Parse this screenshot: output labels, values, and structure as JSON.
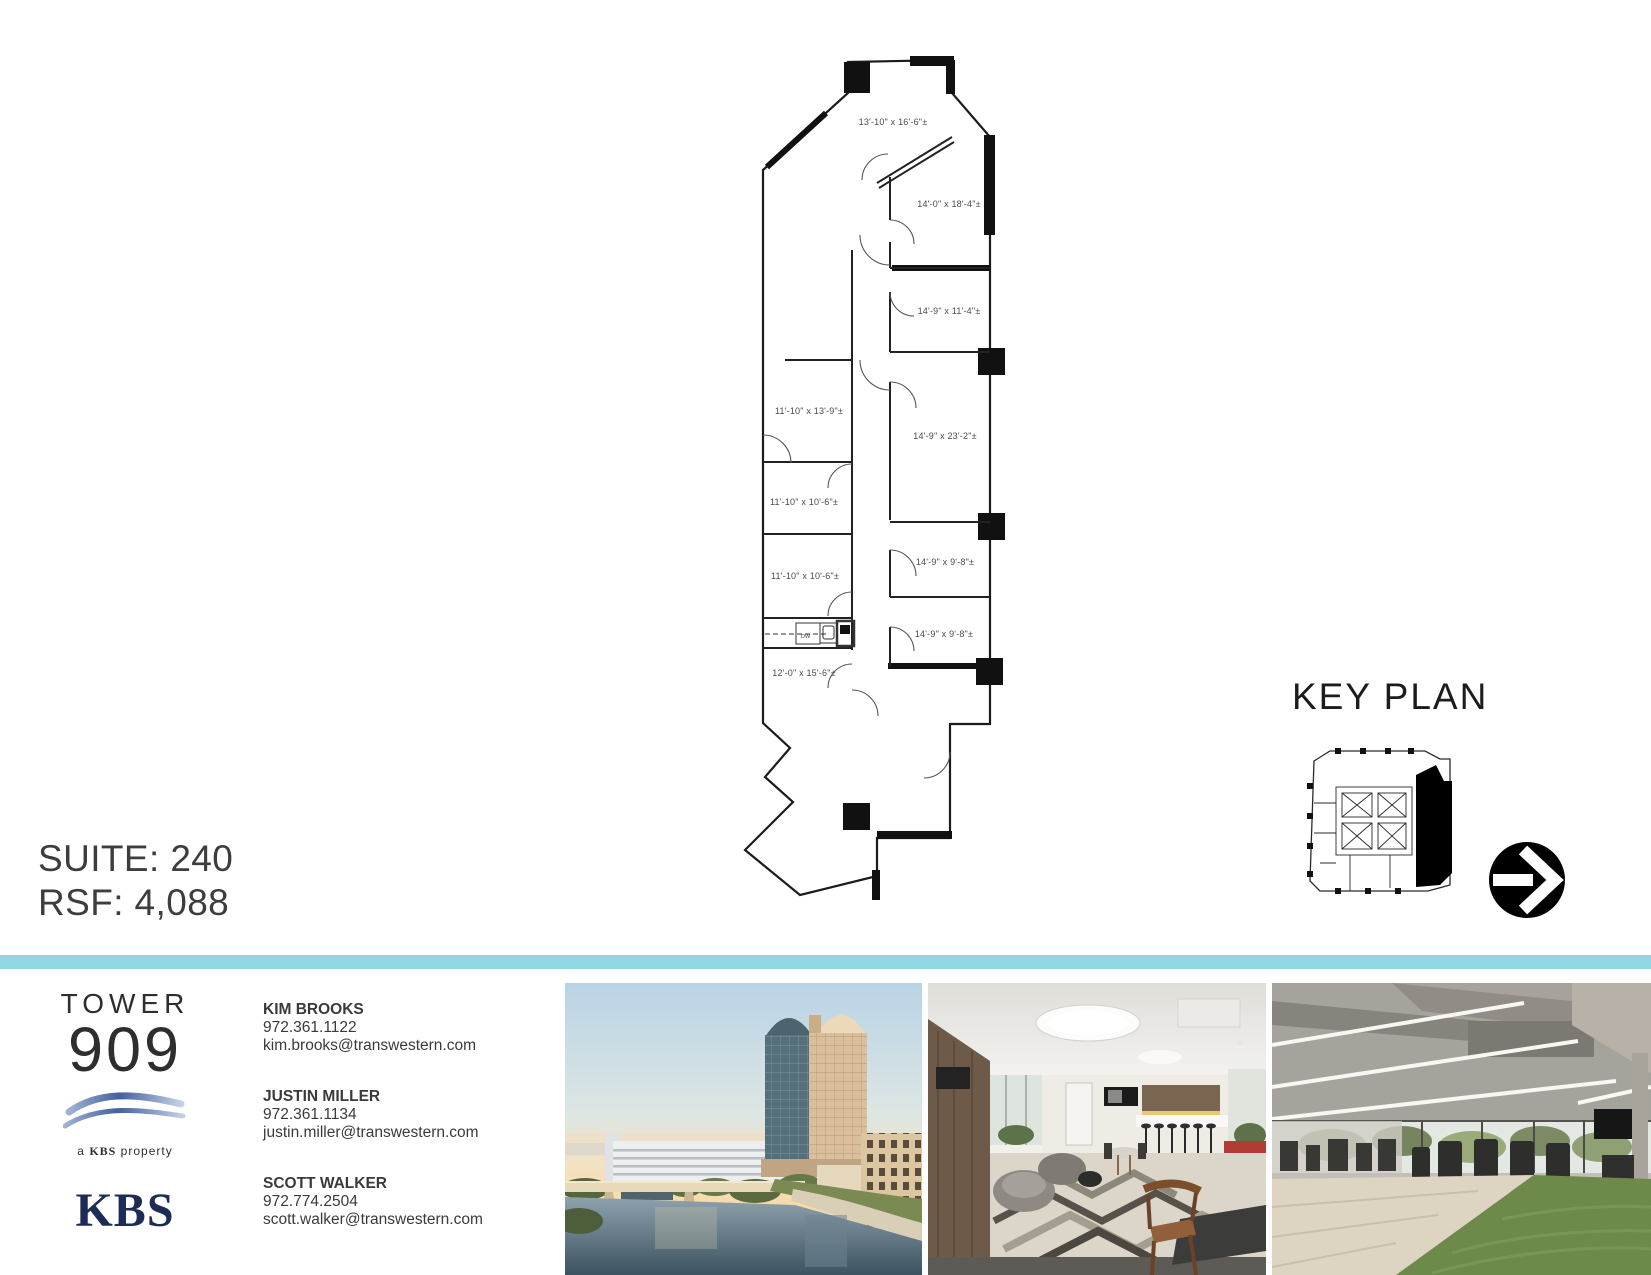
{
  "page": {
    "suite_label": "SUITE: 240",
    "rsf_label": "RSF: 4,088"
  },
  "key_plan": {
    "title": "KEY PLAN"
  },
  "floor_plan": {
    "room_labels": [
      "13'-10\" x 16'-6\"±",
      "14'-0\" x 18'-4\"±",
      "14'-9\" x 11'-4\"±",
      "11'-10\" x 13'-9\"±",
      "14'-9\" x 23'-2\"±",
      "11'-10\" x 10'-6\"±",
      "14'-9\" x 9'-8\"±",
      "11'-10\" x 10'-6\"±",
      "14'-9\" x 9'-8\"±",
      "12'-0\" x 15'-6\"±"
    ],
    "kitchen_label": "DW"
  },
  "branding": {
    "building_name_line1": "TOWER",
    "building_name_line2": "909",
    "tagline_a": "a",
    "tagline_b": "KBS",
    "tagline_c": "property",
    "owner_logo": "KBS"
  },
  "contacts": [
    {
      "name": "KIM BROOKS",
      "phone": "972.361.1122",
      "email": "kim.brooks@transwestern.com"
    },
    {
      "name": "JUSTIN MILLER",
      "phone": "972.361.1134",
      "email": "justin.miller@transwestern.com"
    },
    {
      "name": "SCOTT WALKER",
      "phone": "972.774.2504",
      "email": "scott.walker@transwestern.com"
    }
  ],
  "photos": [
    {
      "name": "building-exterior-aerial"
    },
    {
      "name": "tenant-lounge-interior"
    },
    {
      "name": "fitness-center"
    }
  ],
  "colors": {
    "accent_teal": "#8fd8e2",
    "text_dark": "#3a3a3a",
    "kbs_navy": "#1d2b57"
  }
}
